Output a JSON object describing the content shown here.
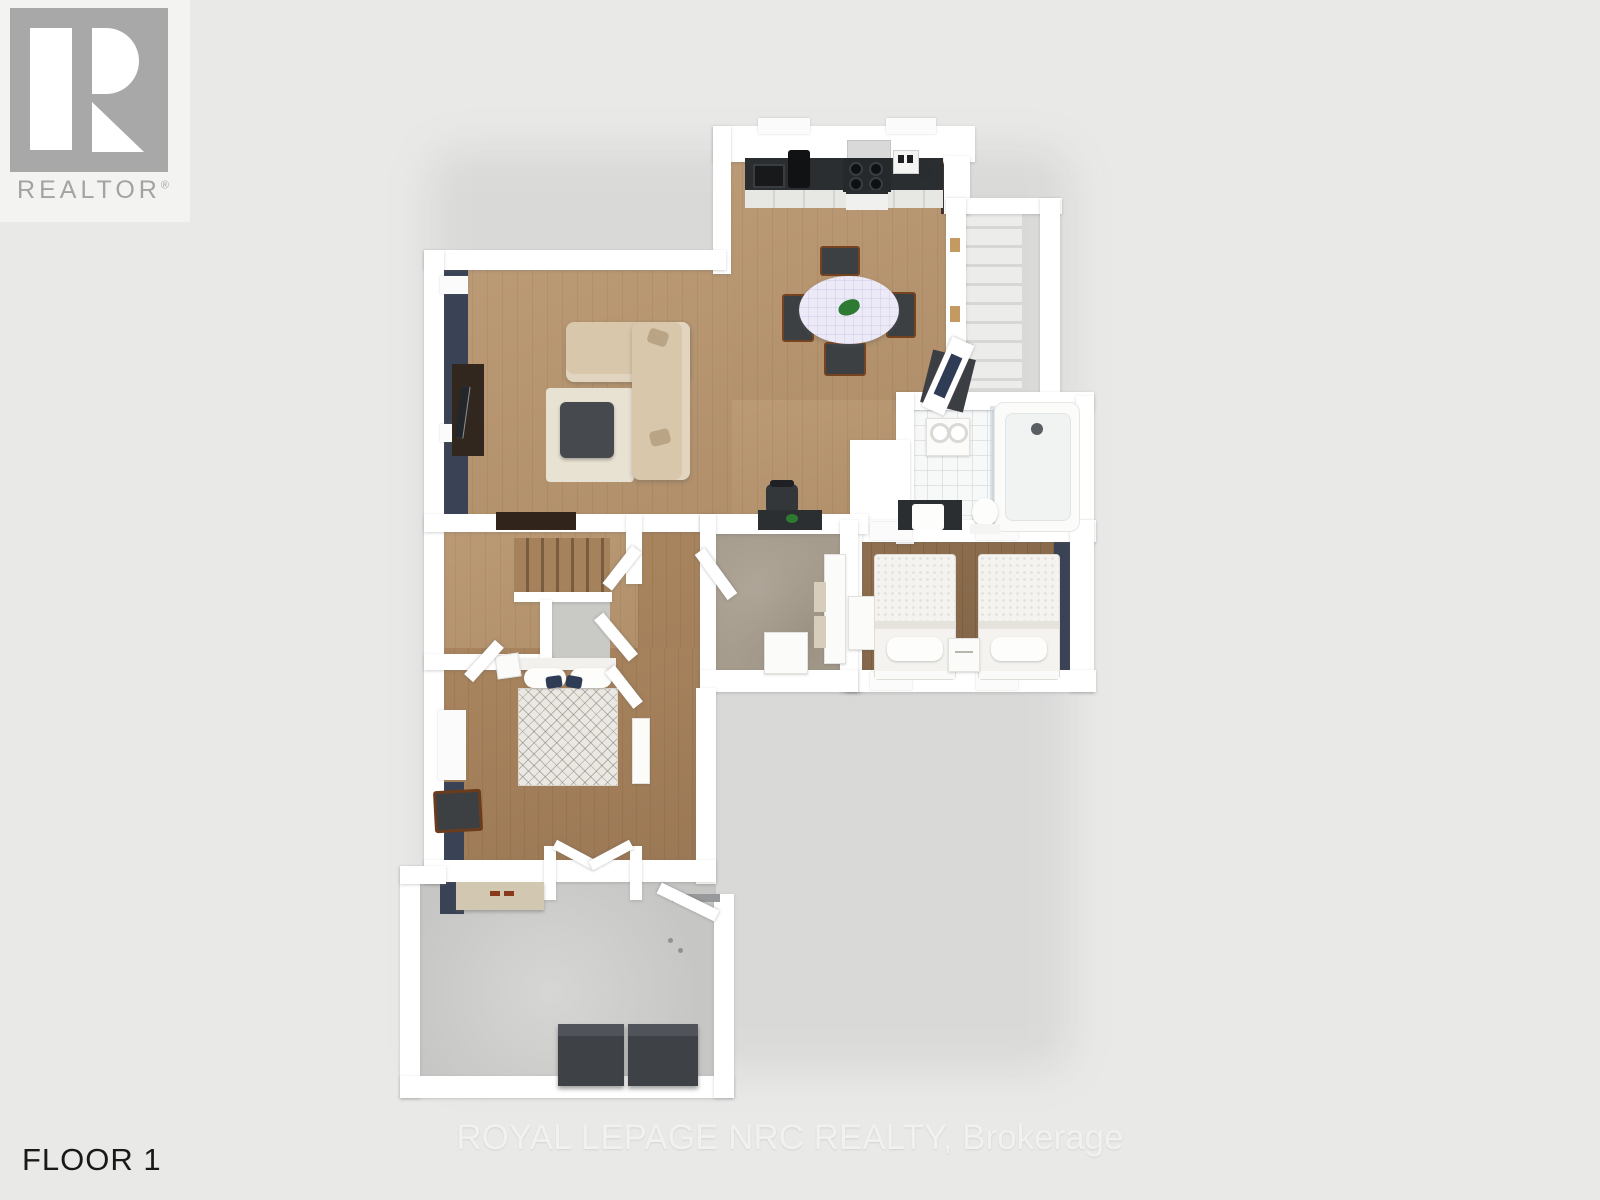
{
  "branding": {
    "logo_text": "REALTOR",
    "registered": "®"
  },
  "labels": {
    "floor": "FLOOR 1"
  },
  "watermark": {
    "text": "ROYAL LEPAGE NRC REALTY, Brokerage"
  },
  "rooms": [
    "kitchen",
    "dining-area",
    "living-room",
    "entry",
    "bathroom",
    "twin-bedroom",
    "master-bedroom",
    "laundry-room",
    "stairwell",
    "garage"
  ],
  "colors": {
    "background": "#e9e9e8",
    "card": "#f3f3f2",
    "logo_gray": "#a8a8a8",
    "logo_text_gray": "#a3a3a3",
    "text_dark": "#191919",
    "watermark": "#f2f2f0",
    "wall": "#ffffff",
    "wall_window": "#fbfbfb",
    "navy": "#3a4355",
    "wood_light": "#b5946f",
    "wood_medium": "#a5825f",
    "wood_dark": "#8a6c4e",
    "tile_taupe": "#a69c8d",
    "concrete": "#c6c6c4",
    "concrete_light": "#c9c9c6",
    "counter_dark": "#2b2e30",
    "sofa_beige": "#d8c7ab",
    "rug_cream": "#e8e2d3",
    "ottoman_gray": "#46494e",
    "console_brown": "#32271e",
    "tablecloth": "#eceaf6",
    "chair_dark": "#3c4043",
    "chair_wood": "#75431f",
    "plant_green": "#2f7a33",
    "dresser_beige": "#d2c7b0",
    "box_dark": "#3e4246",
    "door_glass": "#2e3d55",
    "mat_dark": "#3b3e42"
  }
}
